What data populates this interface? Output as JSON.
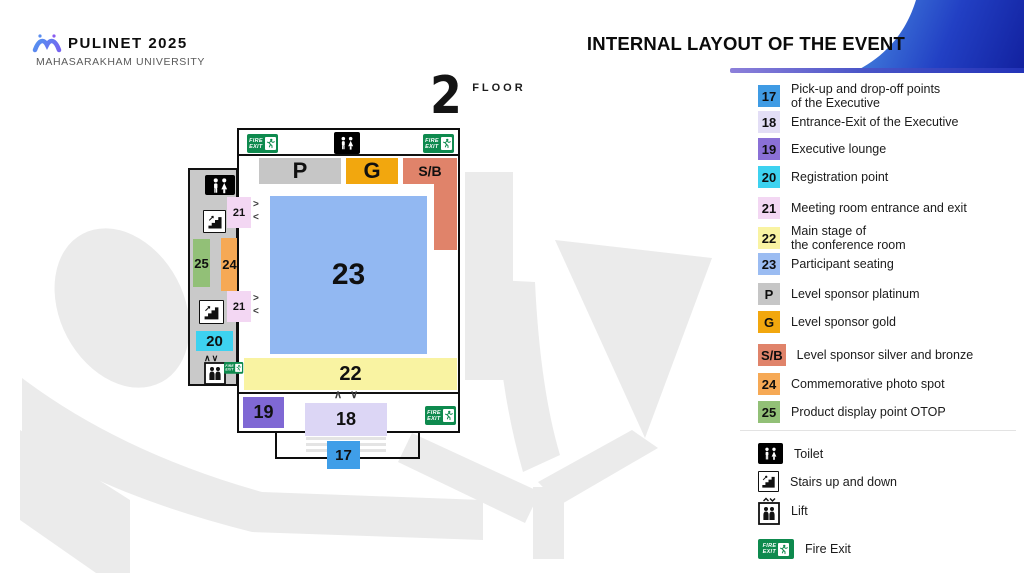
{
  "header": {
    "logo_title": "PULINET 2025",
    "logo_subtitle": "MAHASARAKHAM UNIVERSITY",
    "page_title": "INTERNAL LAYOUT OF THE EVENT"
  },
  "floor_badge": {
    "number": "2",
    "label": "FLOOR"
  },
  "map": {
    "zones": {
      "platinum": {
        "label": "P",
        "color": "#c6c6c6"
      },
      "gold": {
        "label": "G",
        "color": "#f2a70e"
      },
      "silver_bronze": {
        "label": "S/B",
        "color": "#e0836a"
      },
      "seating": {
        "label": "23",
        "color": "#92b8f2"
      },
      "stage": {
        "label": "22",
        "color": "#f9f3a2"
      },
      "lounge": {
        "label": "19",
        "color": "#7f68d4"
      },
      "entrance": {
        "label": "18",
        "color": "#dcd6f5"
      },
      "pickup": {
        "label": "17",
        "color": "#3f9ee8"
      },
      "registration": {
        "label": "20",
        "color": "#3dd2f0"
      },
      "photo": {
        "label": "24",
        "color": "#f6a955"
      },
      "otop": {
        "label": "25",
        "color": "#92c077"
      },
      "meeting_a": {
        "label": "21",
        "color": "#f3d7f3"
      },
      "meeting_b": {
        "label": "21",
        "color": "#f3d7f3"
      }
    },
    "arrows": {
      "right": ">",
      "left": "<",
      "up": "∧",
      "down": "∨"
    },
    "fire_exit_sign": {
      "line1": "FIRE",
      "line2": "EXIT"
    }
  },
  "legend": {
    "items": [
      {
        "badge": "17",
        "color": "#3f9be4",
        "label": "Pick-up and drop-off points",
        "label2": "of the Executive"
      },
      {
        "badge": "18",
        "color": "#e3def6",
        "label": "Entrance-Exit of the Executive",
        "label2": ""
      },
      {
        "badge": "19",
        "color": "#8a70d6",
        "label": "Executive lounge",
        "label2": ""
      },
      {
        "badge": "20",
        "color": "#3dd2f0",
        "label": "Registration point",
        "label2": ""
      },
      {
        "badge": "21",
        "color": "#f3d7f3",
        "label": "Meeting room entrance and exit",
        "label2": ""
      },
      {
        "badge": "22",
        "color": "#f9f3a2",
        "label": "Main stage of",
        "label2": "the conference room"
      },
      {
        "badge": "23",
        "color": "#9bbcf2",
        "label": "Participant seating",
        "label2": ""
      },
      {
        "badge": "P",
        "color": "#c6c6c6",
        "label": "Level sponsor platinum",
        "label2": ""
      },
      {
        "badge": "G",
        "color": "#f2a70e",
        "label": "Level sponsor gold",
        "label2": ""
      },
      {
        "badge": "S/B",
        "color": "#e0836a",
        "label": "Level sponsor silver and bronze",
        "label2": ""
      },
      {
        "badge": "24",
        "color": "#f6a955",
        "label": "Commemorative photo spot",
        "label2": ""
      },
      {
        "badge": "25",
        "color": "#92c077",
        "label": "Product display point OTOP",
        "label2": ""
      }
    ],
    "facilities": [
      {
        "icon": "toilet-icon",
        "label": "Toilet"
      },
      {
        "icon": "stairs-icon",
        "label": "Stairs up and down"
      },
      {
        "icon": "lift-icon",
        "label": "Lift"
      },
      {
        "icon": "fire-exit-icon",
        "label": "Fire Exit"
      }
    ]
  },
  "colors": {
    "accent_bar_left": "#8d80da",
    "accent_bar_right": "#2333b8",
    "corner_from": "#4b8fe2",
    "corner_to": "#12219f",
    "fire_exit_green": "#0e8a4e",
    "watermark_gray": "#ebebeb"
  }
}
